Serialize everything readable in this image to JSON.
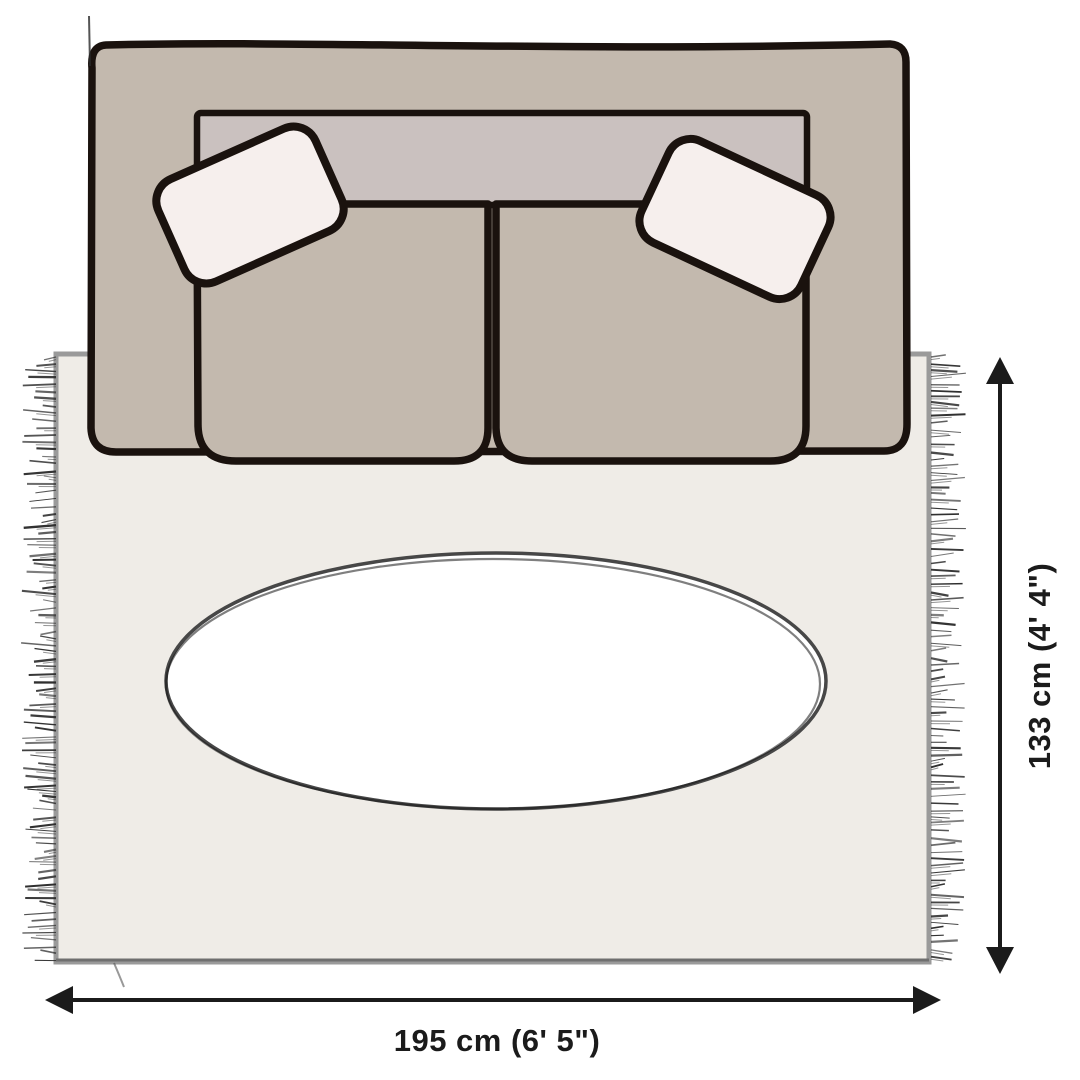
{
  "diagram": {
    "dimensions": {
      "height": {
        "label": "133 cm (4' 4\")"
      },
      "width": {
        "label": "195 cm (6' 5\")"
      }
    }
  },
  "palette": {
    "background": "#ffffff",
    "sofa_body": "#c3b9ae",
    "sofa_back": "#cac1bf",
    "outline": "#1a120e",
    "pillow": "#f6efed",
    "rug": "#efece7",
    "rug_border": "#9a9a9a",
    "rug_border_dark": "#6f6f6f",
    "table_fill": "#ffffff",
    "table_stroke": "#474747",
    "table_stroke_dark": "#161616",
    "fringe": "#2d2d2d",
    "dimension": "#1b1b1b"
  }
}
